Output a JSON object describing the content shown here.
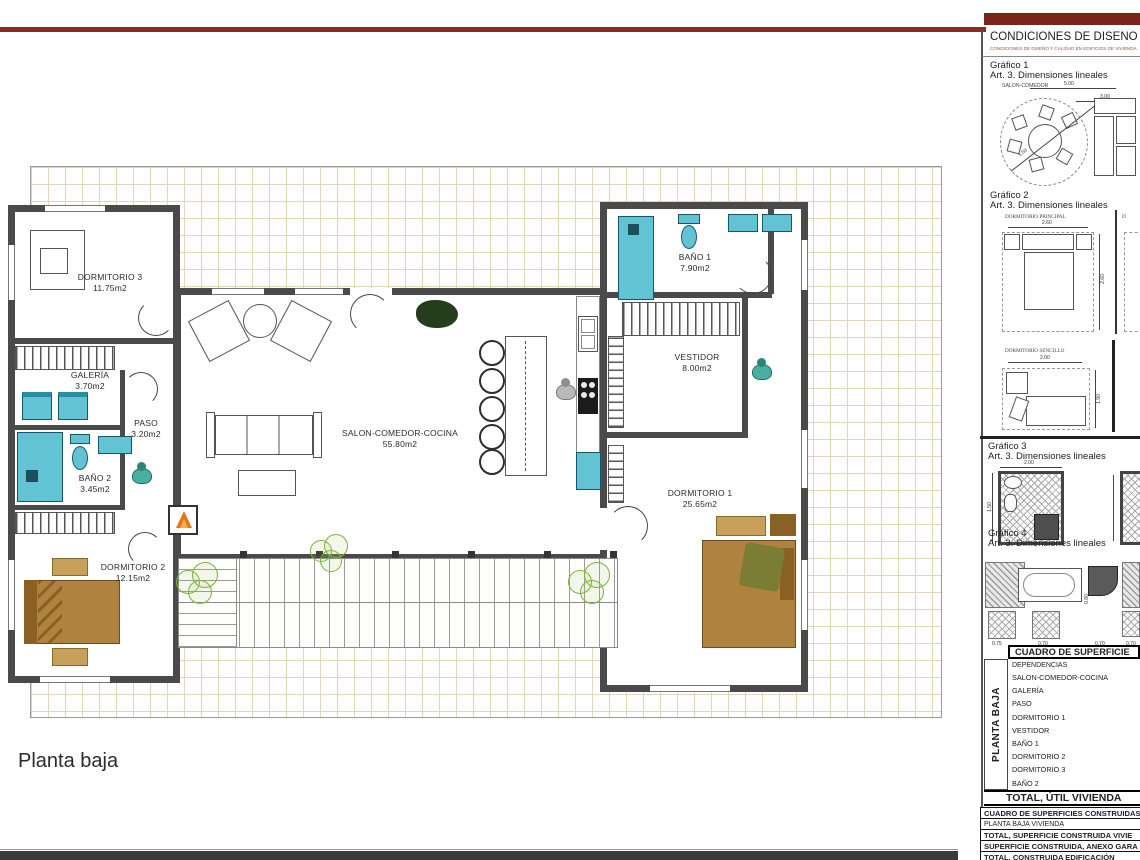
{
  "title": {
    "plan_label": "Planta baja"
  },
  "colors": {
    "accent_red": "#7b241c",
    "fixture_cyan": "#62c3d4",
    "bed_brown": "#b0823f",
    "plant_green": "#7fb043",
    "wall_gray": "#4a4a4a",
    "tile_tan": "#e3d5ba"
  },
  "plan": {
    "rooms": [
      {
        "name": "DORMITORIO 3",
        "area": "11.75m2"
      },
      {
        "name": "GALERÍA",
        "area": "3.70m2"
      },
      {
        "name": "PASO",
        "area": "3.20m2"
      },
      {
        "name": "BAÑO 2",
        "area": "3.45m2"
      },
      {
        "name": "DORMITORIO 2",
        "area": "12.15m2"
      },
      {
        "name": "SALON-COMEDOR-COCINA",
        "area": "55.80m2"
      },
      {
        "name": "BAÑO 1",
        "area": "7.90m2"
      },
      {
        "name": "VESTIDOR",
        "area": "8.00m2"
      },
      {
        "name": "DORMITORIO 1",
        "area": "25.65m2"
      }
    ]
  },
  "panel": {
    "header": "CONDICIONES DE DISEÑO y C",
    "subheader": "CONDICIONES DE DISEÑO Y CALIDAD EN EDIFICIOS DE VIVIENDA",
    "grafico1": {
      "title": "Gráfico 1",
      "subtitle": "Art. 3. Dimensiones lineales",
      "label": "SALON-COMEDOR",
      "dim_w": "5.00",
      "dim_h": "3.00",
      "dim_diag": "3.50"
    },
    "grafico2": {
      "title": "Gráfico 2",
      "subtitle": "Art. 3. Dimensiones lineales",
      "label": "DORMITORIO PRINCIPAL",
      "dim_w": "2.60",
      "dim_h": "2.60",
      "partial_label": "D"
    },
    "sencillo": {
      "label": "DORMITORIO SENCILLO",
      "dim_w": "2.00",
      "dim_h": "1.90"
    },
    "grafico3": {
      "title": "Gráfico 3",
      "subtitle": "Art. 3. Dimensiones lineales",
      "dim_w": "2.00",
      "dim_h": "1.50"
    },
    "grafico4": {
      "title": "Gráfico 4",
      "subtitle": "Art. 3. Dimensiones lineales",
      "dims": [
        "0.75",
        "0.70",
        "0.80",
        "0.70",
        "0.70"
      ]
    },
    "surface_table": {
      "title": "CUADRO DE SUPERFICIE",
      "col_header": "DEPENDENCIAS",
      "side_label": "PLANTA BAJA",
      "rows": [
        "SALON-COMEDOR-COCINA",
        "GALERÍA",
        "PASO",
        "DORMITORIO 1",
        "VESTIDOR",
        "BAÑO 1",
        "DORMITORIO 2",
        "DORMITORIO 3",
        "BAÑO 2"
      ],
      "total_label": "TOTAL, ÚTIL VIVIENDA"
    },
    "built_table": {
      "title": "CUADRO DE SUPERFICIES CONSTRUIDAS",
      "rows": [
        "PLANTA BAJA VIVIENDA",
        "TOTAL, SUPERFICIE CONSTRUIDA VIVIE",
        "SUPERFICIE CONSTRUIDA, ANEXO GARA",
        "TOTAL, CONSTRUIDA EDIFICACIÓN"
      ]
    }
  }
}
